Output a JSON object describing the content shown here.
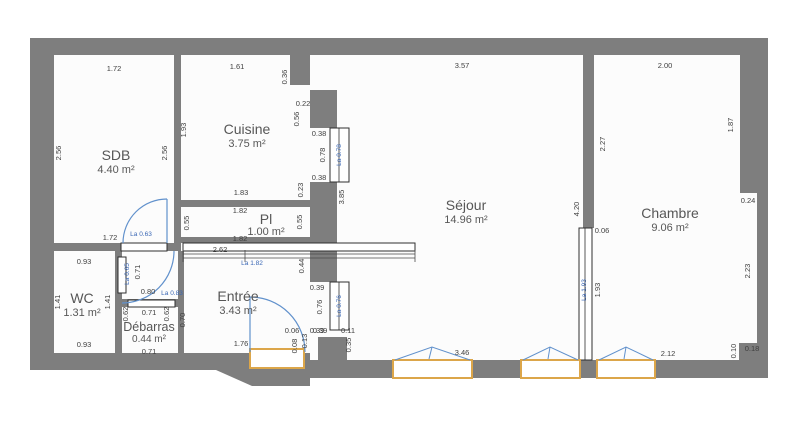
{
  "plan_type": "apartment-floor-plan",
  "colors": {
    "wall": "#7e7e7e",
    "floor": "#fcfcfc",
    "dimension_text": "#3f3f3f",
    "door_label_blue": "#3a67b5",
    "door_arc_blue": "#6191cc",
    "window_frame_orange": "#dca64a"
  },
  "rooms": {
    "sdb": {
      "name": "SDB",
      "area": "4.40 m²"
    },
    "cuisine": {
      "name": "Cuisine",
      "area": "3.75 m²"
    },
    "pl": {
      "name": "Pl",
      "area": "1.00 m²"
    },
    "wc": {
      "name": "WC",
      "area": "1.31 m²"
    },
    "debarras": {
      "name": "Débarras",
      "area": "0.44 m²"
    },
    "entree": {
      "name": "Entrée",
      "area": "3.43 m²"
    },
    "sejour": {
      "name": "Séjour",
      "area": "14.96 m²"
    },
    "chambre": {
      "name": "Chambre",
      "area": "9.06 m²"
    }
  },
  "door_labels": {
    "sdb_door": "La 0.63",
    "vest_door": "La 0.65",
    "debarras_door": "La 0.83",
    "pl_opening": "La 1.82",
    "window1": "La 0.78",
    "window2": "La 0.76",
    "partition": "La 1.93"
  },
  "dims": {
    "sdb_top": "1.72",
    "sdb_left": "2.56",
    "sdb_right": "2.56",
    "sdb_bottom": "1.72",
    "cui_top": "1.61",
    "cui_notch_a": "0.36",
    "cui_notch_b": "0.22",
    "cui_notch_c": "0.56",
    "cui_left": "1.93",
    "cui_bottom": "1.83",
    "cui_b2": "0.23",
    "pl_top": "1.82",
    "pl_left": "0.55",
    "pl_right": "0.55",
    "pl_bottom": "1.82",
    "mid_len": "2.62",
    "mid_v": "0.44",
    "wc_top": "0.93",
    "wc_left": "1.41",
    "wc_right": "1.41",
    "wc_bottom": "0.93",
    "vest_door_v": "0.71",
    "vest_door_w": "0.80",
    "deb_top": "0.71",
    "deb_left": "0.62",
    "deb_right": "0.62",
    "deb_bottom": "0.71",
    "ent_left": "0.70",
    "ent_bottom": "1.76",
    "ent_a": "0.06",
    "ent_b": "0.08",
    "ent_c": "0.13",
    "ent_d": "0.39",
    "sw1_a": "0.38",
    "sw1_b": "0.78",
    "sw1_c": "0.38",
    "sej_left": "3.85",
    "sw2_a": "0.39",
    "sw2_b": "0.76",
    "sw2_c": "0.39",
    "sej_e": "0.11",
    "sej_f": "0.35",
    "sej_top": "3.57",
    "sej_right": "4.20",
    "sej_bottom": "3.46",
    "part_a": "0.06",
    "part_b": "1.93",
    "cha_top": "2.00",
    "cha_left": "2.27",
    "cha_right": "1.87",
    "cha_step": "0.24",
    "cha_right2": "2.23",
    "cha_bottom": "2.12",
    "cha_n1": "0.10",
    "cha_n2": "0.18"
  }
}
